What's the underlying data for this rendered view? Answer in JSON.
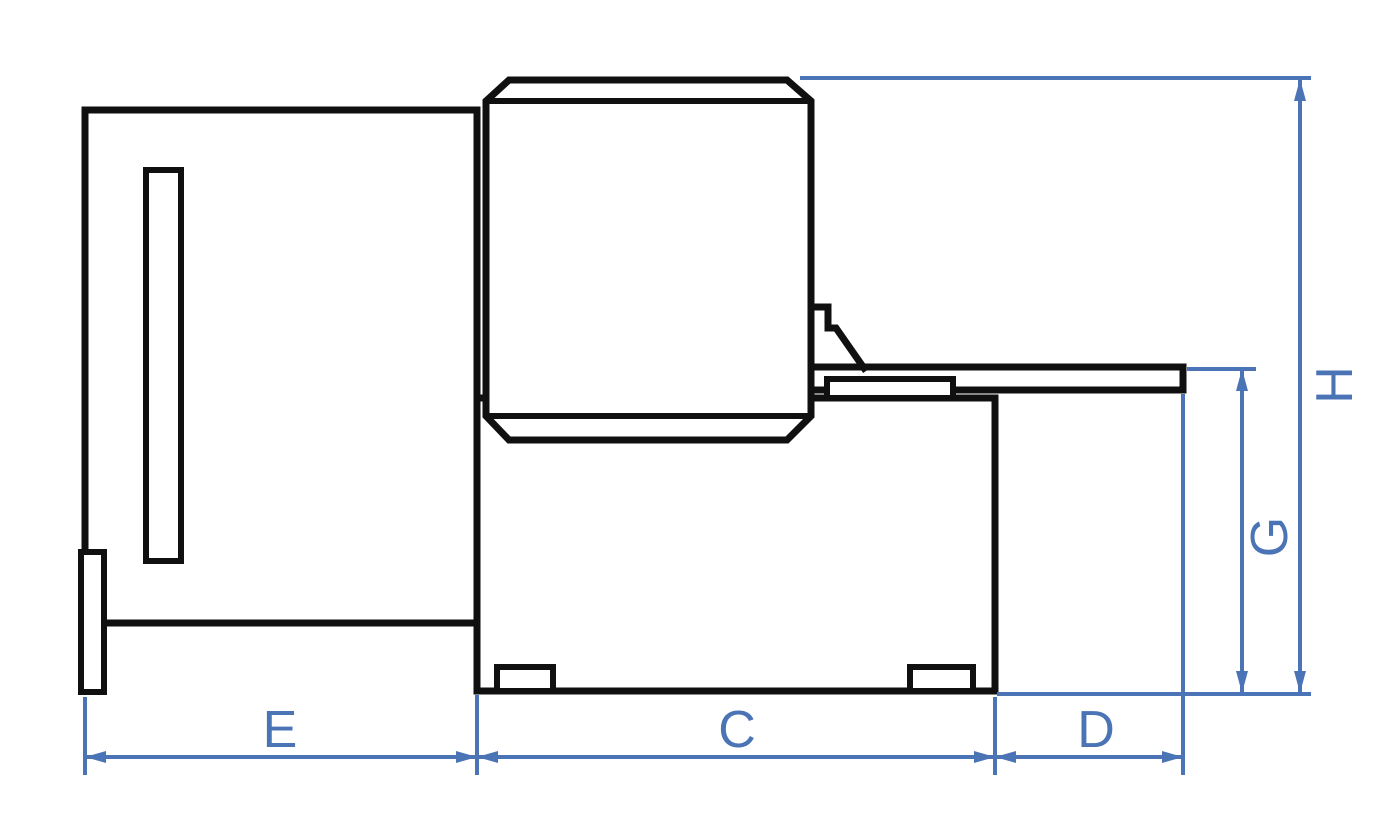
{
  "diagram": {
    "type": "technical-dimension-drawing",
    "colors": {
      "outline": "#101010",
      "dimension": "#4a74b5",
      "background": "#ffffff"
    }
  },
  "labels": {
    "e": "E",
    "c": "C",
    "d": "D",
    "g": "G",
    "h": "H"
  }
}
